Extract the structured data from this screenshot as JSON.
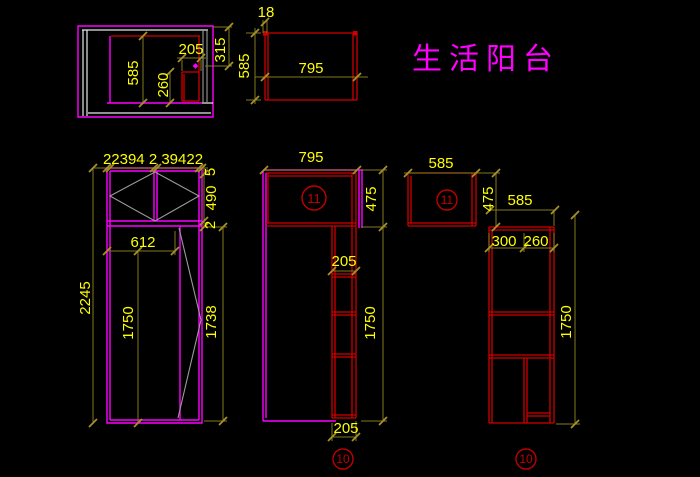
{
  "title": {
    "text": "生活阳台"
  },
  "colors": {
    "background": "#000000",
    "outline_magenta": "#ff00ff",
    "structure_red": "#cf0000",
    "badge_red": "#c00000",
    "dimension_line": "#857a1e",
    "dimension_text": "#ffff00",
    "wall_white": "#e8e8e8",
    "detail_gray": "#9a9a9a",
    "title_color": "#ff00ff"
  },
  "plan_view": {
    "dim_depth": "585",
    "dim_cabinet_depth": "260",
    "dim_cabinet_width": "205",
    "dim_side": "315"
  },
  "top_elevation": {
    "dim_thickness": "18",
    "dim_height": "585",
    "dim_width": "795"
  },
  "left_elevation": {
    "dim_top_segments": "22394 2 39422",
    "dim_frame_top": "5",
    "dim_glass": "490",
    "dim_gap": "2",
    "dim_opening": "612",
    "dim_total_height": "2245",
    "dim_door_height": "1750",
    "dim_door_inner": "1738"
  },
  "mid_elevation": {
    "dim_width": "795",
    "dim_top_height": "475",
    "dim_column_width_top": "205",
    "dim_column_height": "1750",
    "dim_column_width_bottom": "205",
    "badge_top": "11",
    "badge_bottom": "10"
  },
  "right_elevation": {
    "dim_top_width": "585",
    "dim_top_height": "475",
    "dim_width": "585",
    "dim_left_width": "300",
    "dim_right_width": "260",
    "dim_height": "1750",
    "badge_top": "11",
    "badge_bottom": "10"
  }
}
